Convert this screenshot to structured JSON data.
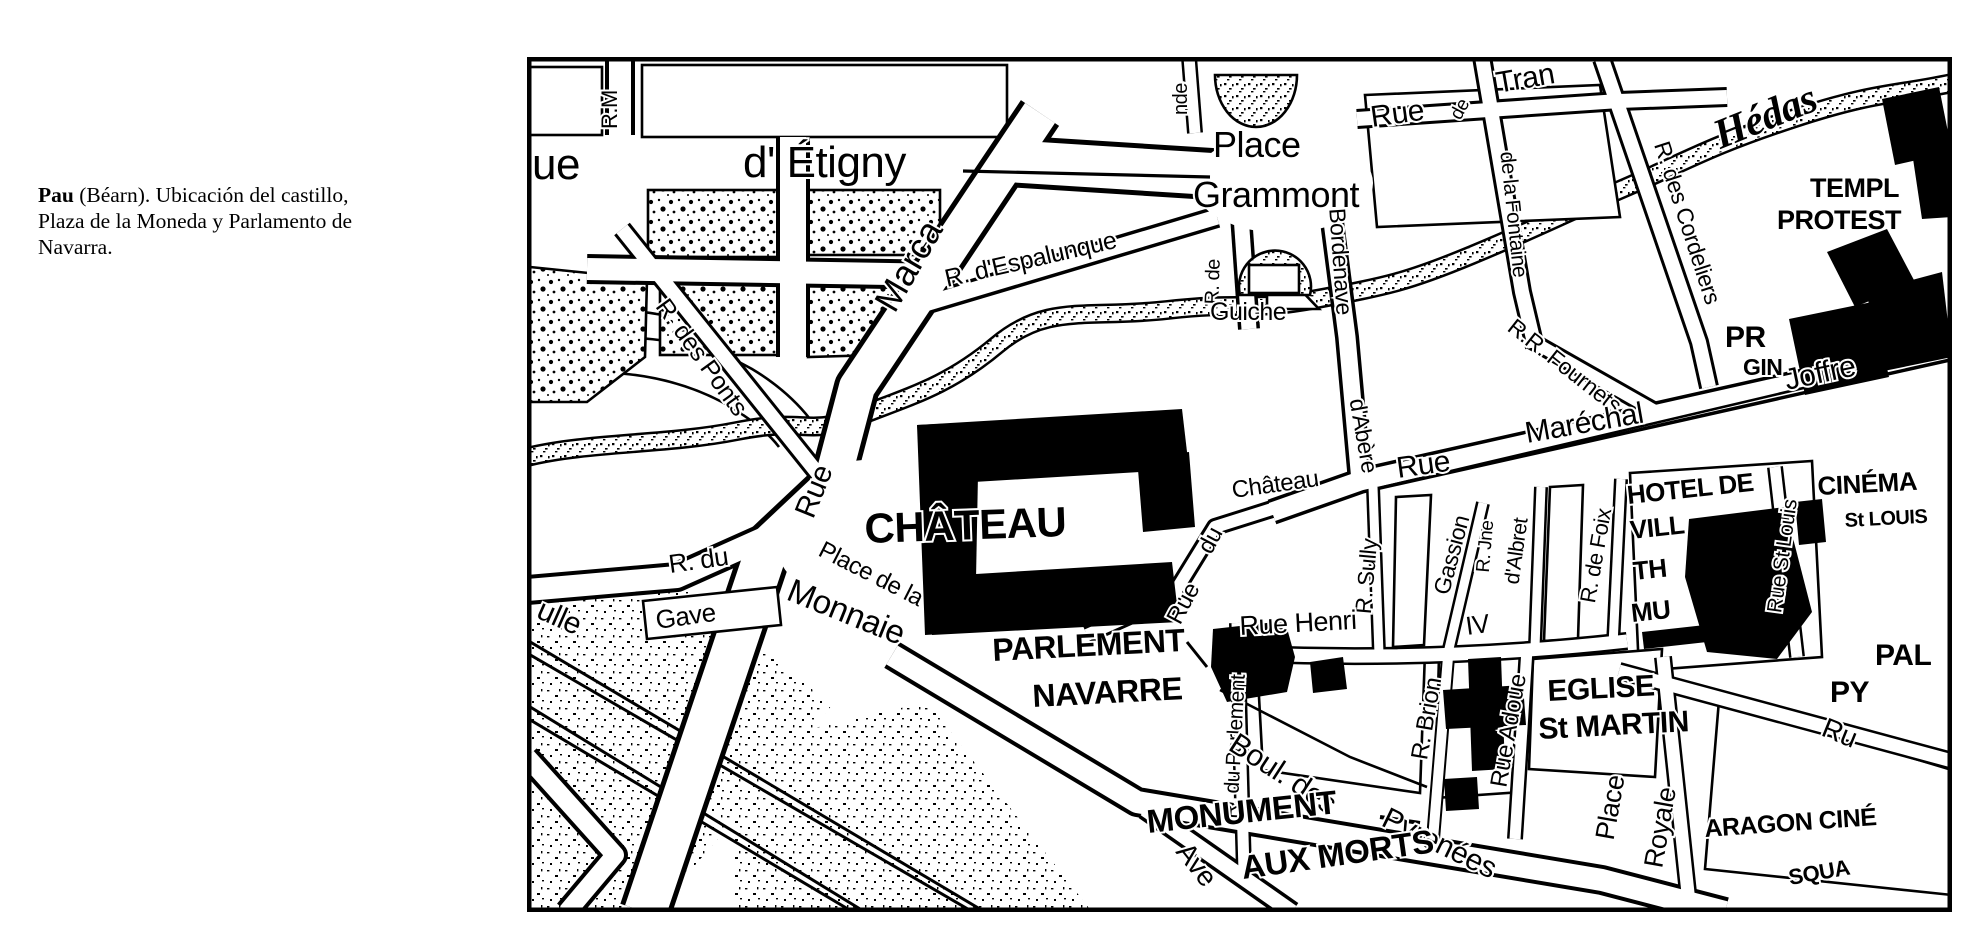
{
  "caption": {
    "bold": "Pau",
    "rest": " (Béarn). Ubicación del castillo, Plaza de la Moneda y Parlamento de Navarra."
  },
  "map": {
    "colors": {
      "ink": "#000000",
      "paper": "#ffffff"
    },
    "labels": [
      {
        "t": "ue",
        "x": 5,
        "y": 122,
        "s": 44
      },
      {
        "t": "d' Étigny",
        "x": 216,
        "y": 120,
        "s": 44
      },
      {
        "t": "R.M",
        "x": 90,
        "y": 72,
        "r": -90,
        "s": 22
      },
      {
        "t": "nde",
        "x": 660,
        "y": 58,
        "r": -90,
        "s": 20
      },
      {
        "t": "Place",
        "x": 686,
        "y": 100,
        "s": 36
      },
      {
        "t": "Grammont",
        "x": 666,
        "y": 150,
        "s": 36
      },
      {
        "t": "R. d'Espalunque",
        "x": 420,
        "y": 230,
        "r": -13,
        "s": 25
      },
      {
        "t": "R. de",
        "x": 692,
        "y": 225,
        "r": -88,
        "s": 20,
        "a": "middle"
      },
      {
        "t": "Guiche",
        "x": 683,
        "y": 263,
        "s": 25
      },
      {
        "t": "Bordenave",
        "x": 806,
        "y": 205,
        "r": 86,
        "s": 23,
        "a": "middle"
      },
      {
        "t": "d'Abère",
        "x": 829,
        "y": 380,
        "r": 80,
        "s": 23,
        "a": "middle"
      },
      {
        "t": "Rue",
        "x": 845,
        "y": 70,
        "r": -8,
        "s": 30
      },
      {
        "t": "de",
        "x": 938,
        "y": 55,
        "r": -62,
        "s": 19,
        "a": "middle"
      },
      {
        "t": "Tran",
        "x": 971,
        "y": 36,
        "r": -10,
        "s": 30
      },
      {
        "t": "de la Fontaine",
        "x": 980,
        "y": 158,
        "r": 84,
        "s": 21,
        "a": "middle"
      },
      {
        "t": "R. des Cordeliers",
        "x": 1153,
        "y": 168,
        "r": 72,
        "s": 23,
        "a": "middle"
      },
      {
        "t": "Hédas",
        "x": 1243,
        "y": 72,
        "r": -22,
        "s": 42,
        "i": 1,
        "a": "middle"
      },
      {
        "t": "TEMPL",
        "x": 1283,
        "y": 140,
        "s": 27,
        "b": 1
      },
      {
        "t": "PROTEST",
        "x": 1250,
        "y": 172,
        "s": 27,
        "b": 1
      },
      {
        "t": "PR",
        "x": 1198,
        "y": 290,
        "s": 30,
        "b": 1
      },
      {
        "t": "GIN",
        "x": 1216,
        "y": 318,
        "s": 23,
        "b": 1
      },
      {
        "t": "R.R. Fournets",
        "x": 1033,
        "y": 315,
        "r": 38,
        "s": 23,
        "a": "middle"
      },
      {
        "t": "Rue",
        "x": 871,
        "y": 421,
        "r": -8,
        "s": 30
      },
      {
        "t": "Maréchal",
        "x": 1000,
        "y": 386,
        "r": -10,
        "s": 30
      },
      {
        "t": "Joffre",
        "x": 1260,
        "y": 333,
        "r": -12,
        "s": 30
      },
      {
        "t": "Château",
        "x": 706,
        "y": 441,
        "r": -8,
        "s": 24
      },
      {
        "t": "du",
        "x": 690,
        "y": 487,
        "r": -62,
        "s": 24,
        "a": "middle"
      },
      {
        "t": "Rue",
        "x": 663,
        "y": 550,
        "r": -62,
        "s": 24,
        "a": "middle"
      },
      {
        "t": "CHÂTEAU",
        "x": 338,
        "y": 486,
        "r": -2,
        "s": 42,
        "b": 1,
        "ls": 2
      },
      {
        "t": "R. du",
        "x": 143,
        "y": 516,
        "r": -8,
        "s": 26
      },
      {
        "t": "Gave",
        "x": 130,
        "y": 572,
        "r": -8,
        "s": 26
      },
      {
        "t": "Place de la",
        "x": 290,
        "y": 498,
        "r": 27,
        "s": 24
      },
      {
        "t": "Monnaie",
        "x": 258,
        "y": 542,
        "r": 22,
        "s": 33
      },
      {
        "t": "PARLEMENT",
        "x": 466,
        "y": 604,
        "r": -3,
        "s": 32,
        "b": 1
      },
      {
        "t": "NAVARRE",
        "x": 506,
        "y": 650,
        "r": -3,
        "s": 32,
        "b": 1
      },
      {
        "t": "R. du Parlement",
        "x": 714,
        "y": 690,
        "r": -87,
        "s": 21,
        "a": "middle"
      },
      {
        "t": "R. Sully",
        "x": 847,
        "y": 520,
        "r": -85,
        "s": 23,
        "a": "middle"
      },
      {
        "t": "Gassion",
        "x": 932,
        "y": 500,
        "r": -75,
        "s": 23,
        "a": "middle"
      },
      {
        "t": "R. Jne",
        "x": 964,
        "y": 490,
        "r": -85,
        "s": 19,
        "a": "middle"
      },
      {
        "t": "d'Albret",
        "x": 996,
        "y": 495,
        "r": -82,
        "s": 21,
        "a": "middle"
      },
      {
        "t": "R. de Foix",
        "x": 1076,
        "y": 500,
        "r": -80,
        "s": 22,
        "a": "middle"
      },
      {
        "t": "Rue Henri",
        "x": 713,
        "y": 578,
        "r": -3,
        "s": 27
      },
      {
        "t": "IV",
        "x": 940,
        "y": 578,
        "r": -8,
        "s": 26
      },
      {
        "t": "HOTEL DE",
        "x": 1101,
        "y": 447,
        "r": -6,
        "s": 26,
        "b": 1
      },
      {
        "t": "VILL",
        "x": 1104,
        "y": 482,
        "r": -6,
        "s": 26,
        "b": 1
      },
      {
        "t": "TH",
        "x": 1107,
        "y": 523,
        "r": -6,
        "s": 26,
        "b": 1
      },
      {
        "t": "MU",
        "x": 1105,
        "y": 565,
        "r": -6,
        "s": 26,
        "b": 1
      },
      {
        "t": "CINÉMA",
        "x": 1291,
        "y": 438,
        "r": -3,
        "s": 26,
        "b": 1
      },
      {
        "t": "St LOUIS",
        "x": 1318,
        "y": 470,
        "r": -3,
        "s": 20,
        "b": 1
      },
      {
        "t": "Rue St Louis",
        "x": 1262,
        "y": 500,
        "r": -82,
        "s": 21,
        "a": "middle"
      },
      {
        "t": "PAL",
        "x": 1348,
        "y": 608,
        "s": 30,
        "b": 1
      },
      {
        "t": "PY",
        "x": 1303,
        "y": 645,
        "s": 30,
        "b": 1
      },
      {
        "t": "Ru",
        "x": 1293,
        "y": 678,
        "r": 22,
        "s": 28
      },
      {
        "t": "EGLISE",
        "x": 1021,
        "y": 644,
        "r": -3,
        "s": 30,
        "b": 1
      },
      {
        "t": "St MARTIN",
        "x": 1012,
        "y": 682,
        "r": -3,
        "s": 30,
        "b": 1
      },
      {
        "t": "Place",
        "x": 1092,
        "y": 752,
        "r": -80,
        "s": 27,
        "a": "middle"
      },
      {
        "t": "Royale",
        "x": 1142,
        "y": 772,
        "r": -80,
        "s": 27,
        "a": "middle"
      },
      {
        "t": "ARAGON CINÉ",
        "x": 1178,
        "y": 780,
        "r": -4,
        "s": 25,
        "b": 1
      },
      {
        "t": "SQUA",
        "x": 1263,
        "y": 828,
        "r": -10,
        "s": 22,
        "b": 1
      },
      {
        "t": "Rue Adoue",
        "x": 989,
        "y": 675,
        "r": -80,
        "s": 24,
        "a": "middle"
      },
      {
        "t": "R. Brion",
        "x": 907,
        "y": 663,
        "r": -80,
        "s": 24,
        "a": "middle"
      },
      {
        "t": "Boul. des",
        "x": 700,
        "y": 692,
        "r": 33,
        "s": 30
      },
      {
        "t": "Pyrenées",
        "x": 853,
        "y": 768,
        "r": 26,
        "s": 30
      },
      {
        "t": "MONUMENT",
        "x": 621,
        "y": 776,
        "r": -6,
        "s": 33,
        "b": 1
      },
      {
        "t": "AUX MORTS",
        "x": 716,
        "y": 822,
        "r": -8,
        "s": 33,
        "b": 1
      },
      {
        "t": "Ave",
        "x": 648,
        "y": 795,
        "r": 52,
        "s": 28
      },
      {
        "t": "ulle",
        "x": 8,
        "y": 560,
        "r": 24,
        "s": 30
      },
      {
        "t": "R. des Ponts",
        "x": 168,
        "y": 305,
        "r": 54,
        "s": 25,
        "a": "middle"
      },
      {
        "t": "Rue",
        "x": 296,
        "y": 438,
        "r": -68,
        "s": 30,
        "a": "middle"
      },
      {
        "t": "Marca",
        "x": 392,
        "y": 215,
        "r": -60,
        "s": 36,
        "a": "middle"
      }
    ]
  }
}
